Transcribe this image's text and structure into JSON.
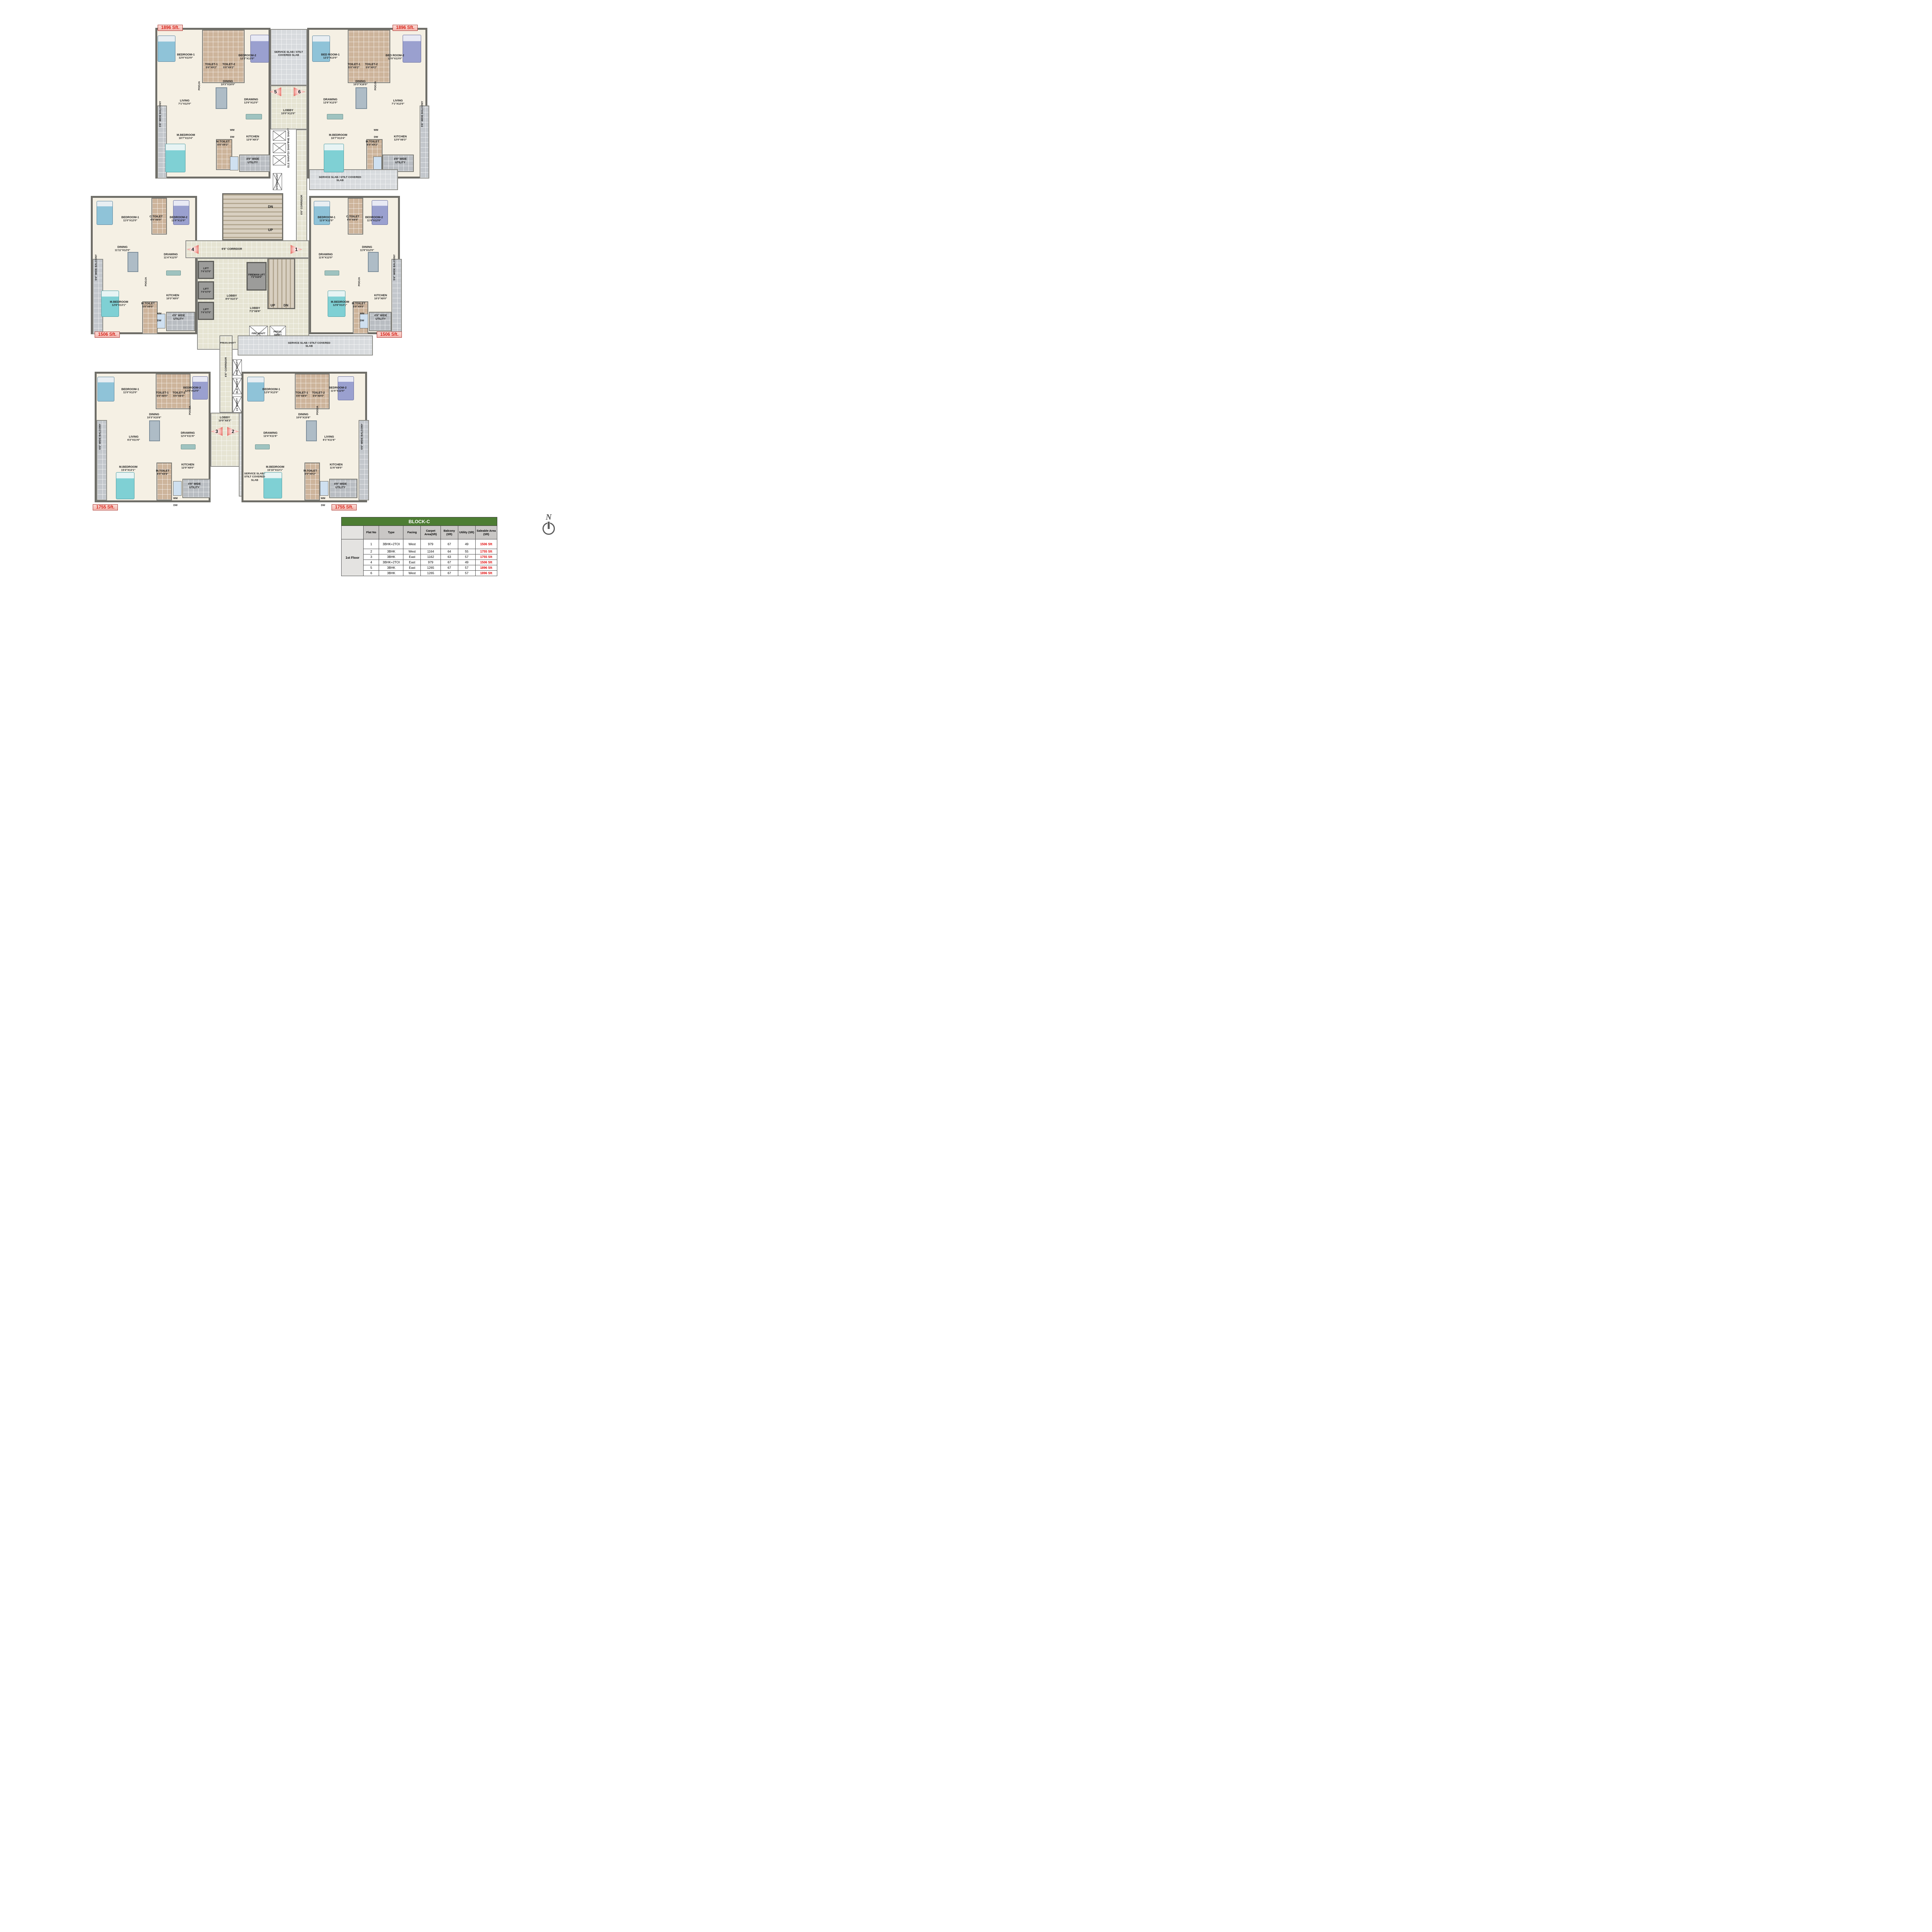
{
  "north_label": "N",
  "badges": {
    "tl": "1896 Sft.",
    "tr": "1896 Sft.",
    "ml": "1506 Sft.",
    "mr": "1506 Sft.",
    "bl": "1755 Sft.",
    "br": "1755 Sft."
  },
  "markers": {
    "m1": "1",
    "m2": "2",
    "m3": "3",
    "m4": "4",
    "m5": "5",
    "m6": "6"
  },
  "labels": {
    "wm": "WM",
    "dw": "DW",
    "utility": "4'9\" WIDE UTILITY",
    "balcony": "5'6\" WIDE BALCONY",
    "pooja": "POOJA"
  },
  "core": {
    "service_slab": "SERVICE SLAB / STILT COVERED SLAB",
    "corridor": "6'6\" CORRIDOR",
    "lobby_top": {
      "name": "LOBBY",
      "dims": "10'0\"X12'0\""
    },
    "lobby_main": {
      "name": "LOBBY",
      "dims": "8'0\"X22'3\""
    },
    "lobby_small": {
      "name": "LOBBY",
      "dims": "7'2\"X8'9\""
    },
    "lobby_bottom": {
      "name": "LOBBY",
      "dims": "10'0\"X8'3\""
    },
    "fireman_lift": {
      "name": "FIREMAN LIFT",
      "dims": "7'2\"X10'0\""
    },
    "lift": {
      "name": "LIFT",
      "dims": "7'4\"X7'0\""
    },
    "up": "UP",
    "dn": "DN",
    "fire_shaft": "FIRE SHAFT",
    "press_shaft": "PRESS.SHAFT",
    "press_shaft2": "PRESS. SHAFT",
    "phe_shaft": "PHE SHAFT",
    "lv_shaft": "LV SHAFT",
    "ele_shaft": "ELE SHAFT",
    "stp_exhaust": "STP.EXHAUST"
  },
  "units": {
    "tl": {
      "bedroom1": {
        "name": "BEDROOM-1",
        "dims": "12'0\"X13'0\""
      },
      "toilet1": {
        "name": "TOILET-1",
        "dims": "5'0\"X9'2\""
      },
      "toilet2": {
        "name": "TOILET-2",
        "dims": "5'0\"X9'2\""
      },
      "bedroom2": {
        "name": "BEDROOM-2",
        "dims": "12'2\"X13'0\""
      },
      "dining": {
        "name": "DINING",
        "dims": "10'3\"X16'0\""
      },
      "living": {
        "name": "LIVING",
        "dims": "7'1\"X12'0\""
      },
      "drawing": {
        "name": "DRAWING",
        "dims": "12'6\"X12'0\""
      },
      "mbedroom": {
        "name": "M.BEDROOM",
        "dims": "16'7\"X13'4\""
      },
      "mtoilet": {
        "name": "M.TOILET",
        "dims": "6'0\"X9'2\""
      },
      "kitchen": {
        "name": "KITCHEN",
        "dims": "12'0\"X8'3\""
      }
    },
    "tr": {
      "bedroom1": {
        "name": "BED ROOM-1",
        "dims": "12'2\"X13'0\""
      },
      "toilet1": {
        "name": "TOILET-1",
        "dims": "5'0\"X9'2\""
      },
      "toilet2": {
        "name": "TOILET-2",
        "dims": "5'0\"X9'2\""
      },
      "bedroom2": {
        "name": "BED ROOM-2",
        "dims": "12'0\"X13'0\""
      },
      "dining": {
        "name": "DINING",
        "dims": "10'3\"X16'0\""
      },
      "drawing": {
        "name": "DRAWING",
        "dims": "12'6\"X12'0\""
      },
      "living": {
        "name": "LIVING",
        "dims": "7'1\"X12'0\""
      },
      "mbedroom": {
        "name": "M.BEDROOM",
        "dims": "16'7\"X13'4\""
      },
      "mtoilet": {
        "name": "M.TOILET",
        "dims": "6'0\"X9'2\""
      },
      "kitchen": {
        "name": "KITCHEN",
        "dims": "12'0\"X8'3\""
      }
    },
    "ml": {
      "bedroom1": {
        "name": "BEDROOM-1",
        "dims": "11'0\"X12'0\""
      },
      "ctoilet": {
        "name": "C.TOILET",
        "dims": "6'0\"X8'0\""
      },
      "bedroom2": {
        "name": "BEDROOM-2",
        "dims": "11'0\"X12'0\""
      },
      "dining": {
        "name": "DINING",
        "dims": "11'11\"X12'0\""
      },
      "drawing": {
        "name": "DRAWING",
        "dims": "11'4\"X12'0\""
      },
      "mbedroom": {
        "name": "M.BEDROOM",
        "dims": "12'8\"X13'1\""
      },
      "mtoilet": {
        "name": "M.TOILET",
        "dims": "5'0\"X9'0\""
      },
      "kitchen": {
        "name": "KITCHEN",
        "dims": "10'3\"X8'0\""
      }
    },
    "mr": {
      "bedroom1": {
        "name": "BEDROOM-1",
        "dims": "11'0\"X12'0\""
      },
      "ctoilet": {
        "name": "C.TOILET",
        "dims": "6'0\"X8'0\""
      },
      "bedroom2": {
        "name": "BEDROOM-2",
        "dims": "11'0\"X12'0\""
      },
      "dining": {
        "name": "DINING",
        "dims": "11'9\"X12'0\""
      },
      "drawing": {
        "name": "DRAWING",
        "dims": "11'6\"X12'0\""
      },
      "mbedroom": {
        "name": "M.BEDROOM",
        "dims": "12'8\"X13'1\""
      },
      "mtoilet": {
        "name": "M.TOILET",
        "dims": "5'0\"X9'0\""
      },
      "kitchen": {
        "name": "KITCHEN",
        "dims": "10'3\"X8'0\""
      }
    },
    "bl": {
      "bedroom1": {
        "name": "BEDROOM-1",
        "dims": "11'0\"X12'0\""
      },
      "toilet1": {
        "name": "TOILET-1",
        "dims": "5'0\"X8'0\""
      },
      "toilet2": {
        "name": "TOILET-2",
        "dims": "5'0\"X8'0\""
      },
      "bedroom2": {
        "name": "BEDROOM-2",
        "dims": "12'0\"X12'0\""
      },
      "dining": {
        "name": "DINING",
        "dims": "10'3\"X15'8\""
      },
      "living": {
        "name": "LIVING",
        "dims": "6'2\"X11'6\""
      },
      "drawing": {
        "name": "DRAWING",
        "dims": "12'4\"X11'6\""
      },
      "mbedroom": {
        "name": "M.BEDROOM",
        "dims": "15'4\"X13'1\""
      },
      "mtoilet": {
        "name": "M.TOILET",
        "dims": "6'0\"X8'8\""
      },
      "kitchen": {
        "name": "KITCHEN",
        "dims": "12'0\"X8'0\""
      }
    },
    "br": {
      "bedroom1": {
        "name": "BEDROOM-1",
        "dims": "12'0\"X12'0\""
      },
      "toilet1": {
        "name": "TOILET-1",
        "dims": "5'0\"X8'0\""
      },
      "toilet2": {
        "name": "TOILET-2",
        "dims": "5'0\"X8'0\""
      },
      "bedroom2": {
        "name": "BEDROOM-2",
        "dims": "11'0\"X12'0\""
      },
      "dining": {
        "name": "DINING",
        "dims": "10'0\"X15'8\""
      },
      "drawing": {
        "name": "DRAWING",
        "dims": "12'4\"X11'6\""
      },
      "living": {
        "name": "LIVING",
        "dims": "6'1\"X11'6\""
      },
      "mbedroom": {
        "name": "M.BEDROOM",
        "dims": "15'10\"X13'1\""
      },
      "mtoilet": {
        "name": "M.TOILET",
        "dims": "6'0\"X9'2\""
      },
      "kitchen": {
        "name": "KITCHEN",
        "dims": "11'6\"X8'0\""
      }
    }
  },
  "table": {
    "title": "BLOCK-C",
    "floor_label": "1st Floor",
    "headers": [
      "Flat No",
      "Type",
      "Facing",
      "Carpet Area(Sft)",
      "Balcony (Sft)",
      "Utility (Sft)",
      "Saleable Area (Sft)"
    ],
    "rows": [
      {
        "flat": "1",
        "type": "3BHK+2TOI",
        "facing": "West",
        "carpet": "979",
        "balcony": "67",
        "utility": "49",
        "saleable": "1506 Sft"
      },
      {
        "flat": "2",
        "type": "3BHK",
        "facing": "West",
        "carpet": "1164",
        "balcony": "64",
        "utility": "55",
        "saleable": "1755 Sft"
      },
      {
        "flat": "3",
        "type": "3BHK",
        "facing": "East",
        "carpet": "1162",
        "balcony": "63",
        "utility": "57",
        "saleable": "1755 Sft"
      },
      {
        "flat": "4",
        "type": "3BHK+2TOI",
        "facing": "East",
        "carpet": "979",
        "balcony": "67",
        "utility": "49",
        "saleable": "1506 Sft"
      },
      {
        "flat": "5",
        "type": "3BHK",
        "facing": "East",
        "carpet": "1265",
        "balcony": "67",
        "utility": "57",
        "saleable": "1896 Sft"
      },
      {
        "flat": "6",
        "type": "3BHK",
        "facing": "West",
        "carpet": "1265",
        "balcony": "67",
        "utility": "57",
        "saleable": "1896 Sft"
      }
    ]
  }
}
